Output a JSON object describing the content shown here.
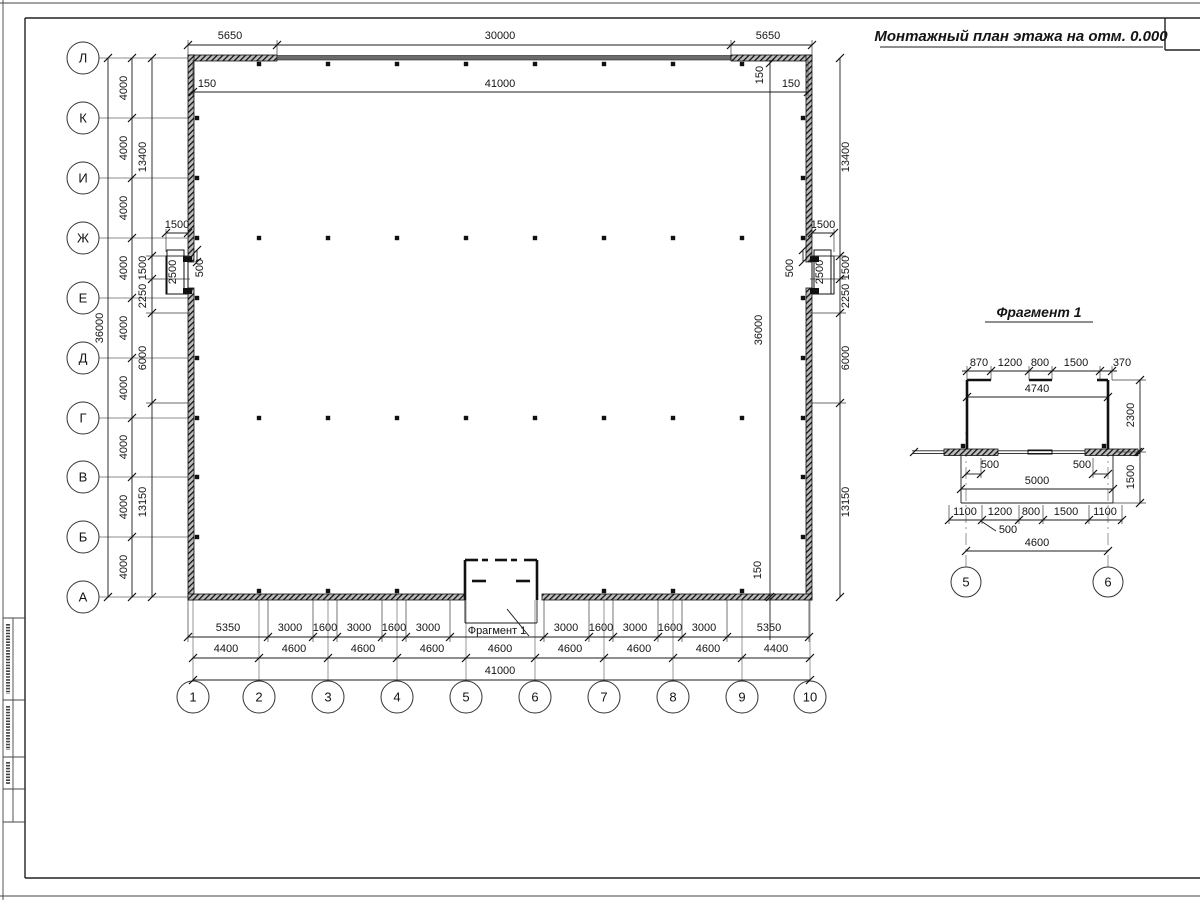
{
  "titles": {
    "main": "Монтажный план этажа на отм. 0.000",
    "fragment": "Фрагмент 1"
  },
  "plan": {
    "fragment_callout": "Фрагмент 1"
  },
  "colors": {
    "ink": "#141414",
    "axis_line": "#8c8c8c",
    "paper": "#ffffff"
  },
  "axes": {
    "rows": [
      {
        "label": "Л",
        "y": 58
      },
      {
        "label": "К",
        "y": 118
      },
      {
        "label": "И",
        "y": 178
      },
      {
        "label": "Ж",
        "y": 238
      },
      {
        "label": "Е",
        "y": 298
      },
      {
        "label": "Д",
        "y": 358
      },
      {
        "label": "Г",
        "y": 418
      },
      {
        "label": "В",
        "y": 477
      },
      {
        "label": "Б",
        "y": 537
      },
      {
        "label": "А",
        "y": 597
      }
    ],
    "cols": [
      {
        "label": "1",
        "x": 193
      },
      {
        "label": "2",
        "x": 259
      },
      {
        "label": "3",
        "x": 328
      },
      {
        "label": "4",
        "x": 397
      },
      {
        "label": "5",
        "x": 466
      },
      {
        "label": "6",
        "x": 535
      },
      {
        "label": "7",
        "x": 604
      },
      {
        "label": "8",
        "x": 673
      },
      {
        "label": "9",
        "x": 742
      },
      {
        "label": "10",
        "x": 810
      }
    ],
    "fragment_cols": [
      {
        "label": "5",
        "x": 966
      },
      {
        "label": "6",
        "x": 1108
      }
    ]
  },
  "dimensions": {
    "labels": [
      [
        "36000",
        103,
        328,
        1
      ],
      [
        "4000",
        127,
        88,
        1
      ],
      [
        "4000",
        127,
        148,
        1
      ],
      [
        "4000",
        127,
        208,
        1
      ],
      [
        "4000",
        127,
        268,
        1
      ],
      [
        "4000",
        127,
        328,
        1
      ],
      [
        "4000",
        127,
        388,
        1
      ],
      [
        "4000",
        127,
        447,
        1
      ],
      [
        "4000",
        127,
        507,
        1
      ],
      [
        "4000",
        127,
        567,
        1
      ],
      [
        "13400",
        146,
        157,
        1
      ],
      [
        "1500",
        146,
        268,
        1
      ],
      [
        "2250",
        146,
        296,
        1
      ],
      [
        "6000",
        146,
        358,
        1
      ],
      [
        "13150",
        146,
        502,
        1
      ],
      [
        "1500",
        177,
        228,
        0
      ],
      [
        "2500",
        176,
        272,
        1,
        1
      ],
      [
        "500",
        203,
        268,
        1
      ],
      [
        "13400",
        849,
        157,
        1
      ],
      [
        "1500",
        849,
        268,
        1
      ],
      [
        "2250",
        849,
        296,
        1
      ],
      [
        "6000",
        849,
        358,
        1
      ],
      [
        "13150",
        849,
        502,
        1
      ],
      [
        "150",
        763,
        75,
        1
      ],
      [
        "36000",
        762,
        330,
        1
      ],
      [
        "150",
        761,
        570,
        1
      ],
      [
        "1500",
        823,
        228,
        0
      ],
      [
        "2500",
        823,
        272,
        1,
        1
      ],
      [
        "500",
        793,
        268,
        1
      ],
      [
        "5650",
        230,
        39
      ],
      [
        "30000",
        500,
        39
      ],
      [
        "5650",
        768,
        39
      ],
      [
        "150",
        207,
        87
      ],
      [
        "41000",
        500,
        87
      ],
      [
        "150",
        791,
        87
      ],
      [
        "5350",
        228,
        631
      ],
      [
        "3000",
        290,
        631
      ],
      [
        "1600",
        325,
        631
      ],
      [
        "3000",
        359,
        631
      ],
      [
        "1600",
        394,
        631
      ],
      [
        "3000",
        428,
        631
      ],
      [
        "3000",
        566,
        631
      ],
      [
        "1600",
        601,
        631
      ],
      [
        "3000",
        635,
        631
      ],
      [
        "1600",
        670,
        631
      ],
      [
        "3000",
        704,
        631
      ],
      [
        "5350",
        769,
        631
      ],
      [
        "4400",
        226,
        652
      ],
      [
        "4600",
        294,
        652
      ],
      [
        "4600",
        363,
        652
      ],
      [
        "4600",
        432,
        652
      ],
      [
        "4600",
        500,
        652
      ],
      [
        "4600",
        570,
        652
      ],
      [
        "4600",
        639,
        652
      ],
      [
        "4600",
        708,
        652
      ],
      [
        "4400",
        776,
        652
      ],
      [
        "41000",
        500,
        674
      ],
      [
        "870",
        979,
        366
      ],
      [
        "1200",
        1010,
        366
      ],
      [
        "800",
        1040,
        366
      ],
      [
        "1500",
        1076,
        366
      ],
      [
        "370",
        1122,
        366
      ],
      [
        "4740",
        1037,
        392
      ],
      [
        "2300",
        1134,
        415,
        1
      ],
      [
        "1500",
        1134,
        477,
        1
      ],
      [
        "500",
        990,
        468
      ],
      [
        "500",
        1082,
        468
      ],
      [
        "5000",
        1037,
        484
      ],
      [
        "1100",
        965,
        515
      ],
      [
        "1200",
        1000,
        515
      ],
      [
        "800",
        1031,
        515
      ],
      [
        "1500",
        1066,
        515
      ],
      [
        "1100",
        1105,
        515
      ],
      [
        "500",
        1008,
        533
      ],
      [
        "4600",
        1037,
        546
      ]
    ]
  },
  "ticks": [
    [
      188,
      45
    ],
    [
      277,
      45
    ],
    [
      731,
      45
    ],
    [
      812,
      45
    ],
    [
      193,
      92
    ],
    [
      808,
      92
    ],
    [
      108,
      58
    ],
    [
      108,
      597
    ],
    [
      132,
      58
    ],
    [
      132,
      118
    ],
    [
      132,
      178
    ],
    [
      132,
      238
    ],
    [
      132,
      298
    ],
    [
      132,
      358
    ],
    [
      132,
      418
    ],
    [
      132,
      477
    ],
    [
      132,
      537
    ],
    [
      132,
      597
    ],
    [
      152,
      58
    ],
    [
      152,
      256
    ],
    [
      152,
      279
    ],
    [
      152,
      313
    ],
    [
      152,
      403
    ],
    [
      152,
      597
    ],
    [
      840,
      58
    ],
    [
      840,
      256
    ],
    [
      840,
      279
    ],
    [
      840,
      313
    ],
    [
      840,
      403
    ],
    [
      840,
      597
    ],
    [
      770,
      63
    ],
    [
      770,
      597
    ],
    [
      166,
      233
    ],
    [
      188,
      233
    ],
    [
      812,
      233
    ],
    [
      834,
      233
    ],
    [
      197,
      250
    ],
    [
      197,
      262
    ],
    [
      803,
      250
    ],
    [
      803,
      262
    ],
    [
      188,
      637
    ],
    [
      268,
      637
    ],
    [
      313,
      637
    ],
    [
      337,
      637
    ],
    [
      382,
      637
    ],
    [
      406,
      637
    ],
    [
      450,
      637
    ],
    [
      544,
      637
    ],
    [
      589,
      637
    ],
    [
      613,
      637
    ],
    [
      658,
      637
    ],
    [
      682,
      637
    ],
    [
      727,
      637
    ],
    [
      809,
      637
    ],
    [
      193,
      658
    ],
    [
      259,
      658
    ],
    [
      328,
      658
    ],
    [
      397,
      658
    ],
    [
      466,
      658
    ],
    [
      535,
      658
    ],
    [
      604,
      658
    ],
    [
      673,
      658
    ],
    [
      742,
      658
    ],
    [
      810,
      658
    ],
    [
      193,
      680
    ],
    [
      810,
      680
    ],
    [
      967,
      371
    ],
    [
      991,
      371
    ],
    [
      1029,
      371
    ],
    [
      1052,
      371
    ],
    [
      1100,
      371
    ],
    [
      1112,
      371
    ],
    [
      967,
      397
    ],
    [
      1108,
      397
    ],
    [
      1140,
      380
    ],
    [
      1140,
      452
    ],
    [
      1140,
      503
    ],
    [
      966,
      474
    ],
    [
      981,
      474
    ],
    [
      1093,
      474
    ],
    [
      1108,
      474
    ],
    [
      961,
      489
    ],
    [
      1113,
      489
    ],
    [
      949,
      520
    ],
    [
      982,
      520
    ],
    [
      1019,
      520
    ],
    [
      1043,
      520
    ],
    [
      1089,
      520
    ],
    [
      1122,
      520
    ],
    [
      966,
      551
    ],
    [
      1108,
      551
    ],
    [
      914,
      452
    ],
    [
      1138,
      452
    ]
  ],
  "column_marks": [
    [
      259,
      64
    ],
    [
      328,
      64
    ],
    [
      397,
      64
    ],
    [
      466,
      64
    ],
    [
      535,
      64
    ],
    [
      604,
      64
    ],
    [
      673,
      64
    ],
    [
      742,
      64
    ],
    [
      259,
      591
    ],
    [
      328,
      591
    ],
    [
      397,
      591
    ],
    [
      604,
      591
    ],
    [
      673,
      591
    ],
    [
      742,
      591
    ],
    [
      197,
      118
    ],
    [
      197,
      178
    ],
    [
      197,
      238
    ],
    [
      197,
      298
    ],
    [
      197,
      358
    ],
    [
      197,
      418
    ],
    [
      197,
      477
    ],
    [
      197,
      537
    ],
    [
      803,
      118
    ],
    [
      803,
      178
    ],
    [
      803,
      238
    ],
    [
      803,
      298
    ],
    [
      803,
      358
    ],
    [
      803,
      418
    ],
    [
      803,
      477
    ],
    [
      803,
      537
    ],
    [
      259,
      238
    ],
    [
      328,
      238
    ],
    [
      397,
      238
    ],
    [
      466,
      238
    ],
    [
      535,
      238
    ],
    [
      604,
      238
    ],
    [
      673,
      238
    ],
    [
      742,
      238
    ],
    [
      259,
      418
    ],
    [
      328,
      418
    ],
    [
      397,
      418
    ],
    [
      466,
      418
    ],
    [
      535,
      418
    ],
    [
      604,
      418
    ],
    [
      673,
      418
    ],
    [
      742,
      418
    ],
    [
      963,
      446
    ],
    [
      1104,
      446
    ]
  ]
}
